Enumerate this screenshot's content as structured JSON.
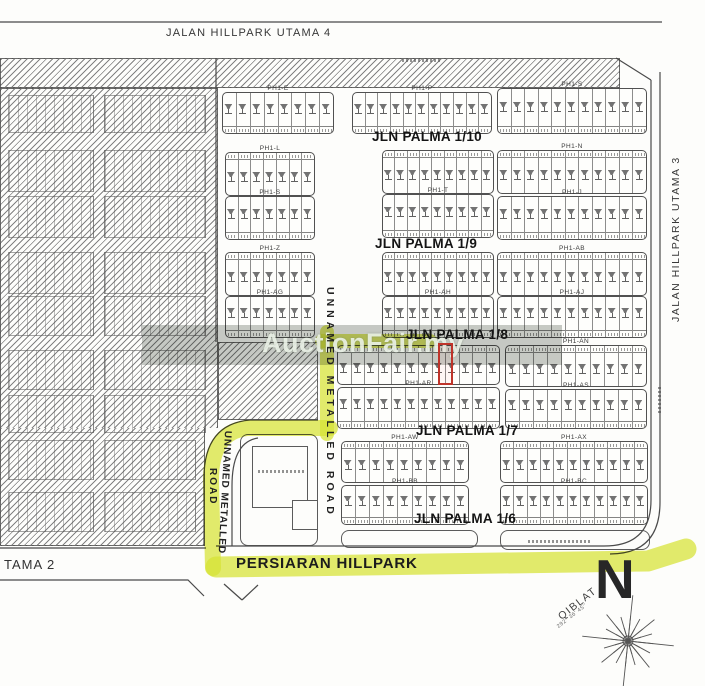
{
  "roads": {
    "top": "JALAN HILLPARK UTAMA 4",
    "right": "JALAN HILLPARK UTAMA 3",
    "bottom": "PERSIARAN HILLPARK",
    "bottom_left": "TAMA 2",
    "unnamed_left_1": "UNNAMED METALLED",
    "unnamed_left_2": "ROAD",
    "unnamed_right": "UNNAMED METALLED ROAD"
  },
  "streets": {
    "p10": "JLN PALMA 1/10",
    "p9": "JLN PALMA 1/9",
    "p8": "JLN PALMA 1/8",
    "p7": "JLN PALMA 1/7",
    "p6": "JLN PALMA 1/6"
  },
  "watermark": {
    "text": "AuctionFair.my"
  },
  "compass": {
    "north": "N",
    "qiblat": "QIBLAT",
    "bearing": "292° 36' 45''"
  },
  "colors": {
    "route_highlight": "#d8e535",
    "subject_marker": "#bf342a",
    "watermark_text": "#f2f8ee",
    "line_work": "#4a4a4a"
  },
  "blocks": [
    {
      "label": "PH1-E",
      "x": 222,
      "y": 92,
      "w": 112,
      "h": 42,
      "cells": 8,
      "num": "bottom"
    },
    {
      "label": "PH1-L",
      "x": 225,
      "y": 152,
      "w": 90,
      "h": 44,
      "cells": 7,
      "num": "top"
    },
    {
      "label": "PH1-S",
      "x": 225,
      "y": 196,
      "w": 90,
      "h": 44,
      "cells": 7,
      "num": "bottom"
    },
    {
      "label": "PH1-Z",
      "x": 225,
      "y": 252,
      "w": 90,
      "h": 44,
      "cells": 7,
      "num": "top"
    },
    {
      "label": "PH1-AG",
      "x": 225,
      "y": 296,
      "w": 90,
      "h": 42,
      "cells": 7,
      "num": "bottom"
    },
    {
      "label": "PH1-P",
      "x": 352,
      "y": 92,
      "w": 140,
      "h": 42,
      "cells": 11,
      "num": "bottom"
    },
    {
      "label": "",
      "x": 382,
      "y": 150,
      "w": 112,
      "h": 44,
      "cells": 9,
      "num": "top"
    },
    {
      "label": "PH1-T",
      "x": 382,
      "y": 194,
      "w": 112,
      "h": 44,
      "cells": 9,
      "num": "bottom"
    },
    {
      "label": "",
      "x": 382,
      "y": 252,
      "w": 112,
      "h": 44,
      "cells": 9,
      "num": "top"
    },
    {
      "label": "PH1-AH",
      "x": 382,
      "y": 296,
      "w": 112,
      "h": 42,
      "cells": 9,
      "num": "bottom"
    },
    {
      "label": "",
      "x": 337,
      "y": 345,
      "w": 163,
      "h": 40,
      "cells": 12,
      "num": "top"
    },
    {
      "label": "PH1-AR",
      "x": 337,
      "y": 387,
      "w": 163,
      "h": 42,
      "cells": 12,
      "num": "bottom"
    },
    {
      "label": "PH1-AW",
      "x": 341,
      "y": 441,
      "w": 128,
      "h": 42,
      "cells": 9,
      "num": "top"
    },
    {
      "label": "PH1-BB",
      "x": 341,
      "y": 485,
      "w": 128,
      "h": 40,
      "cells": 9,
      "num": "bottom"
    },
    {
      "label": "PH1-S",
      "x": 497,
      "y": 88,
      "w": 150,
      "h": 46,
      "cells": 11,
      "num": "bottom"
    },
    {
      "label": "PH1-N",
      "x": 497,
      "y": 150,
      "w": 150,
      "h": 44,
      "cells": 11,
      "num": "top"
    },
    {
      "label": "PH1-J",
      "x": 497,
      "y": 196,
      "w": 150,
      "h": 44,
      "cells": 11,
      "num": "bottom"
    },
    {
      "label": "PH1-AB",
      "x": 497,
      "y": 252,
      "w": 150,
      "h": 44,
      "cells": 11,
      "num": "top"
    },
    {
      "label": "PH1-AJ",
      "x": 497,
      "y": 296,
      "w": 150,
      "h": 42,
      "cells": 11,
      "num": "bottom"
    },
    {
      "label": "PH1-AN",
      "x": 505,
      "y": 345,
      "w": 142,
      "h": 42,
      "cells": 10,
      "num": "top"
    },
    {
      "label": "PH1-AS",
      "x": 505,
      "y": 389,
      "w": 142,
      "h": 40,
      "cells": 10,
      "num": "bottom"
    },
    {
      "label": "PH1-AX",
      "x": 500,
      "y": 441,
      "w": 148,
      "h": 42,
      "cells": 11,
      "num": "top"
    },
    {
      "label": "PH1-BC",
      "x": 500,
      "y": 485,
      "w": 148,
      "h": 40,
      "cells": 11,
      "num": "bottom"
    }
  ]
}
